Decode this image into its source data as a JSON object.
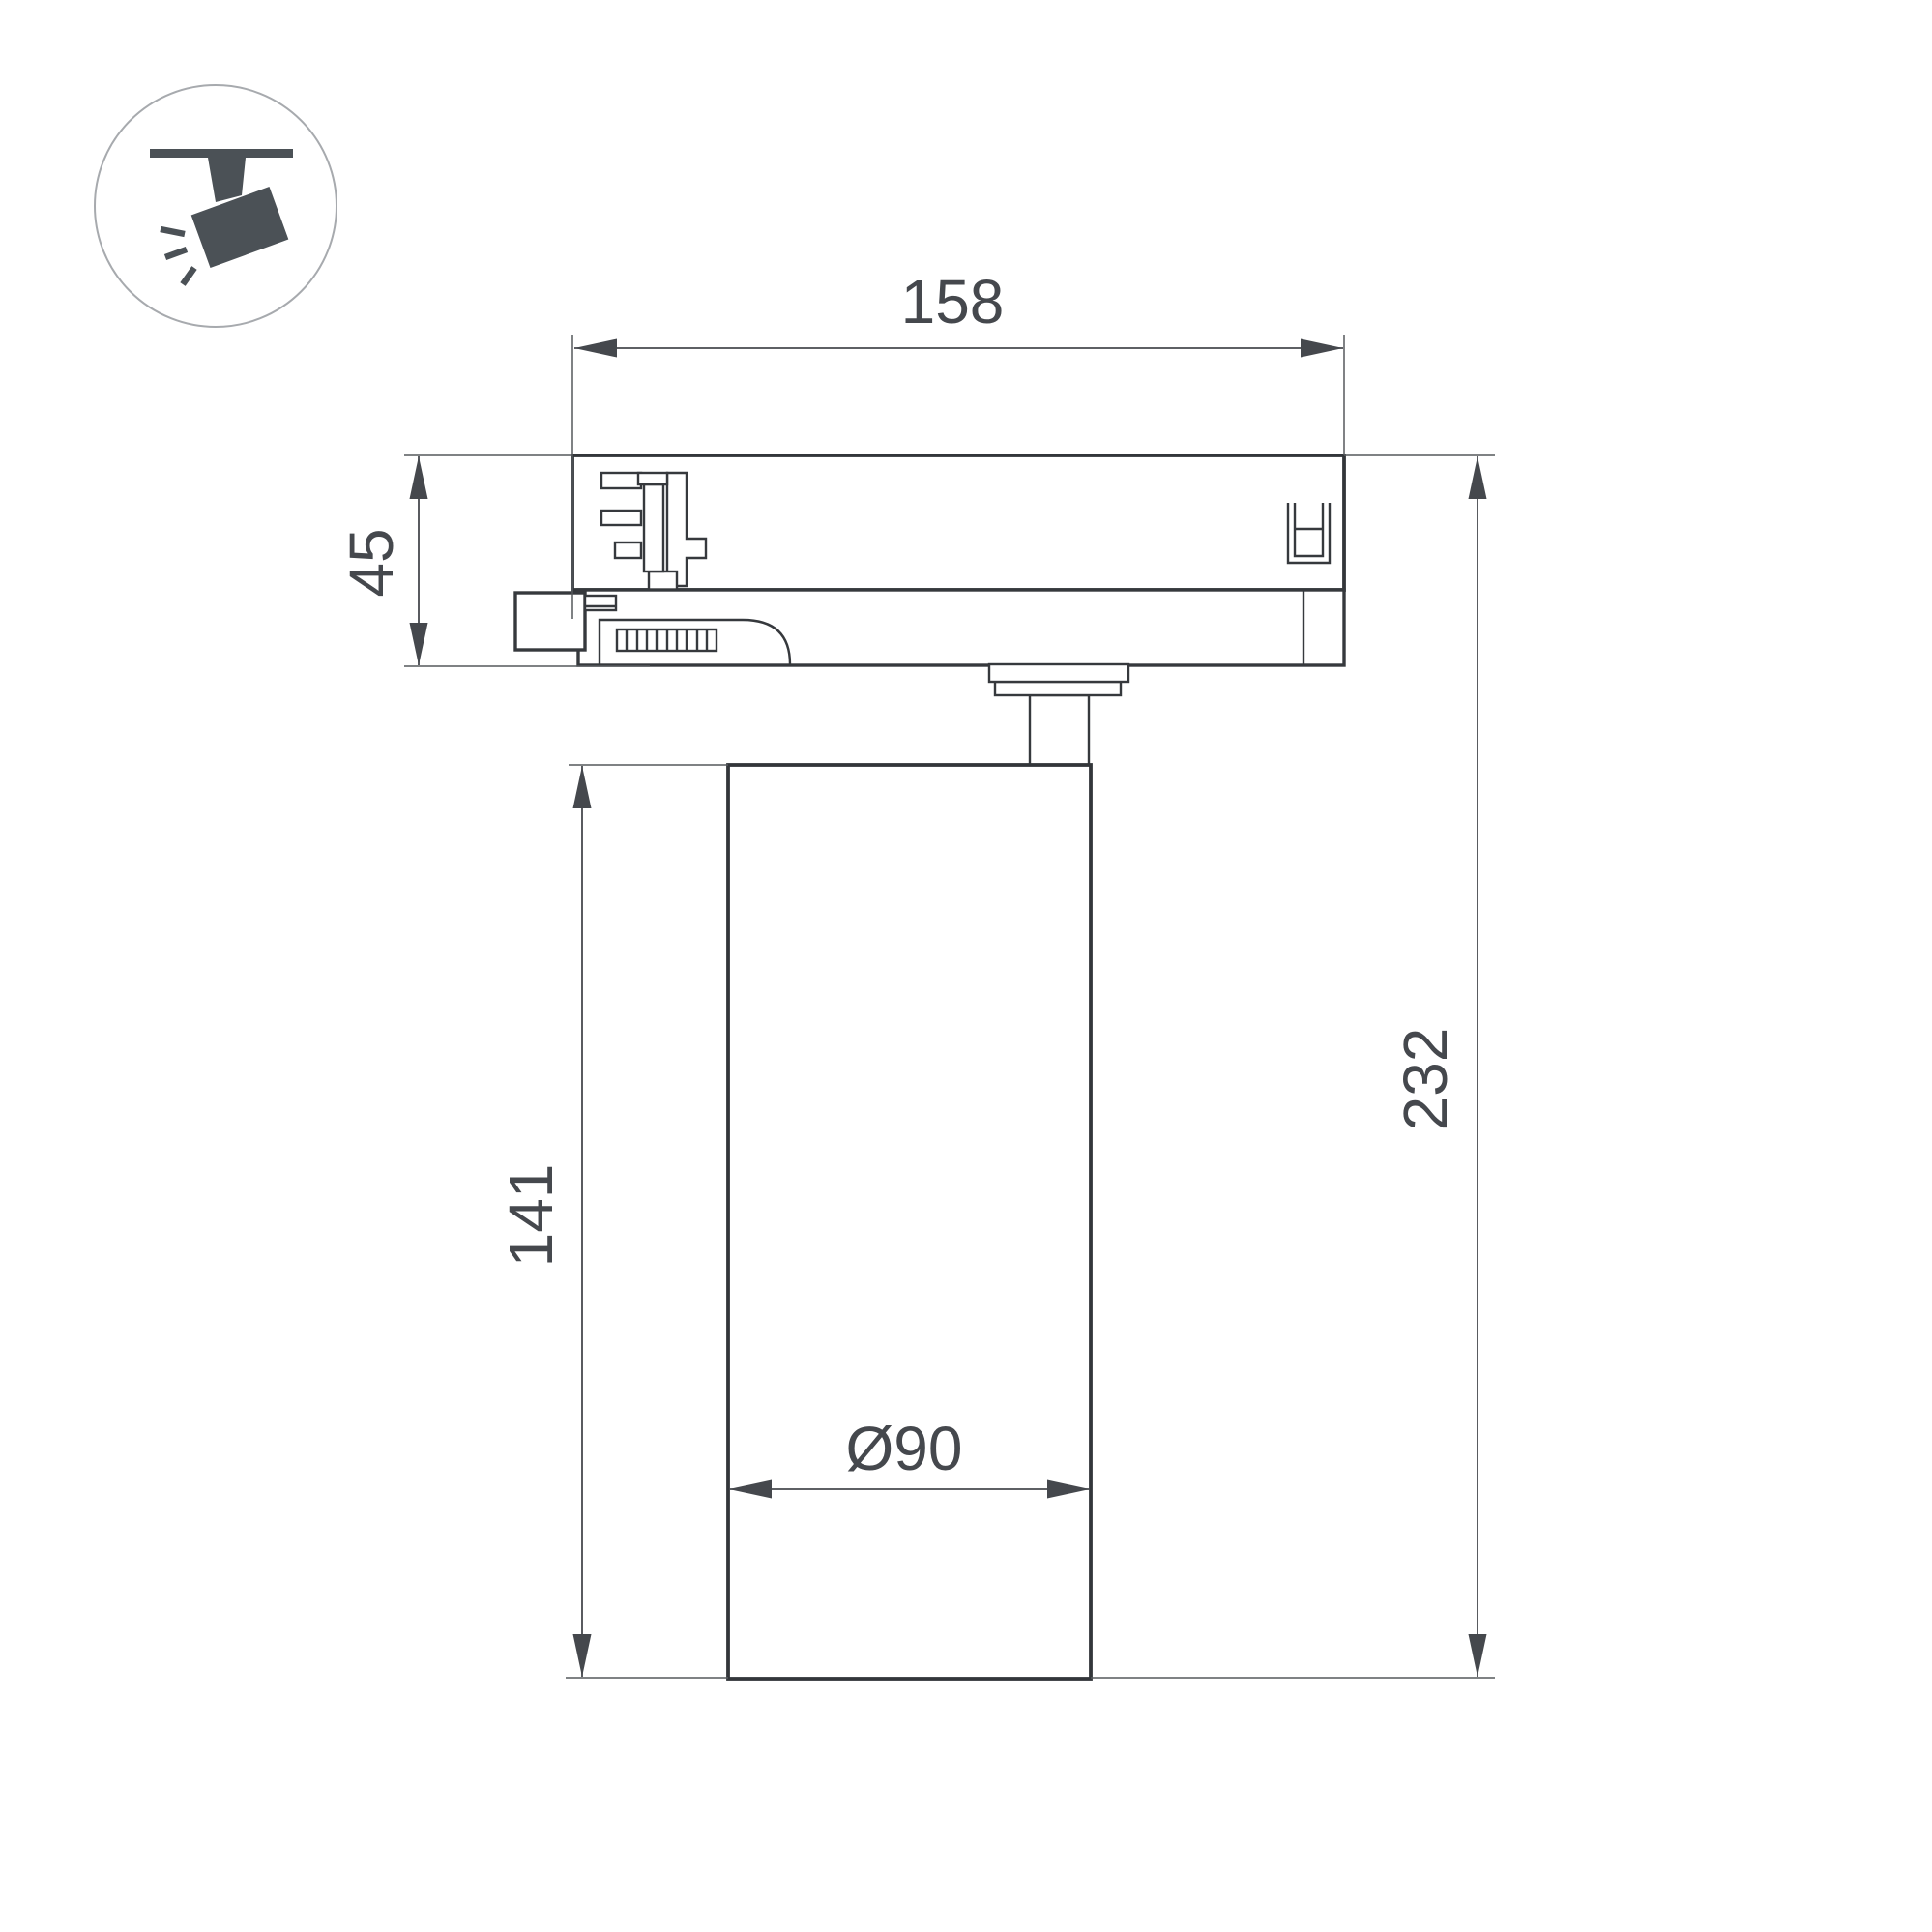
{
  "page": {
    "background": "#ffffff"
  },
  "icon": {
    "name": "track-spotlight-icon",
    "fill": "#4b5156",
    "circle_stroke": "#a7aaae"
  },
  "drawing": {
    "kind": "technical dimension drawing — track-mounted spotlight, side view",
    "line_color": "#36393d",
    "dimension_color": "#47494e",
    "dimensions": {
      "adapter_width": "158",
      "adapter_height": "45",
      "body_height": "141",
      "total_height": "232",
      "body_diameter": "Ø90"
    }
  }
}
